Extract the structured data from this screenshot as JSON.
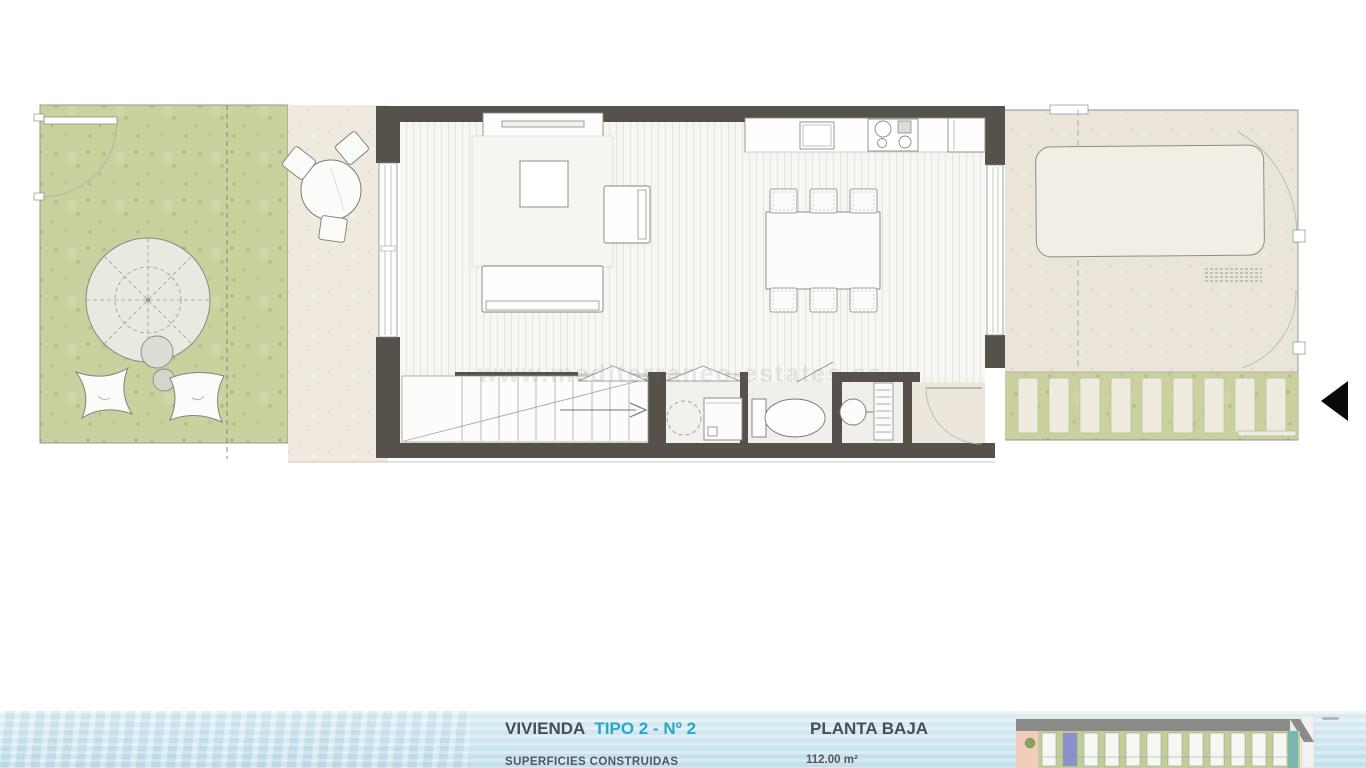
{
  "footer": {
    "unit_label_prefix": "VIVIENDA",
    "unit_label_highlight": "TIPO 2 - Nº 2",
    "plan_label": "PLANTA BAJA",
    "surface_label": "SUPERFICIES CONSTRUIDAS",
    "surface_value": "112.00 m²"
  },
  "watermark": {
    "text": "www.mediterraneo-estates.es"
  },
  "colors": {
    "accent": "#2ba7c9",
    "title_text": "#4c4d52",
    "wall": "#57514b",
    "grass": "#c9d19e",
    "terrace": "#efe9df",
    "patio": "#ebe5d9",
    "water_top": "#e6f3f8",
    "water_bottom": "#c7e2ed",
    "highlighted_unit": "#8a92cb",
    "entrance_arrow": "#0a0a0a"
  },
  "plan_inventory": {
    "dining_chairs": 6,
    "bistro_chairs": 3,
    "bean_bags": 2,
    "paver_steps": 9,
    "stair_treads": 10,
    "site_plan_units": 12
  }
}
